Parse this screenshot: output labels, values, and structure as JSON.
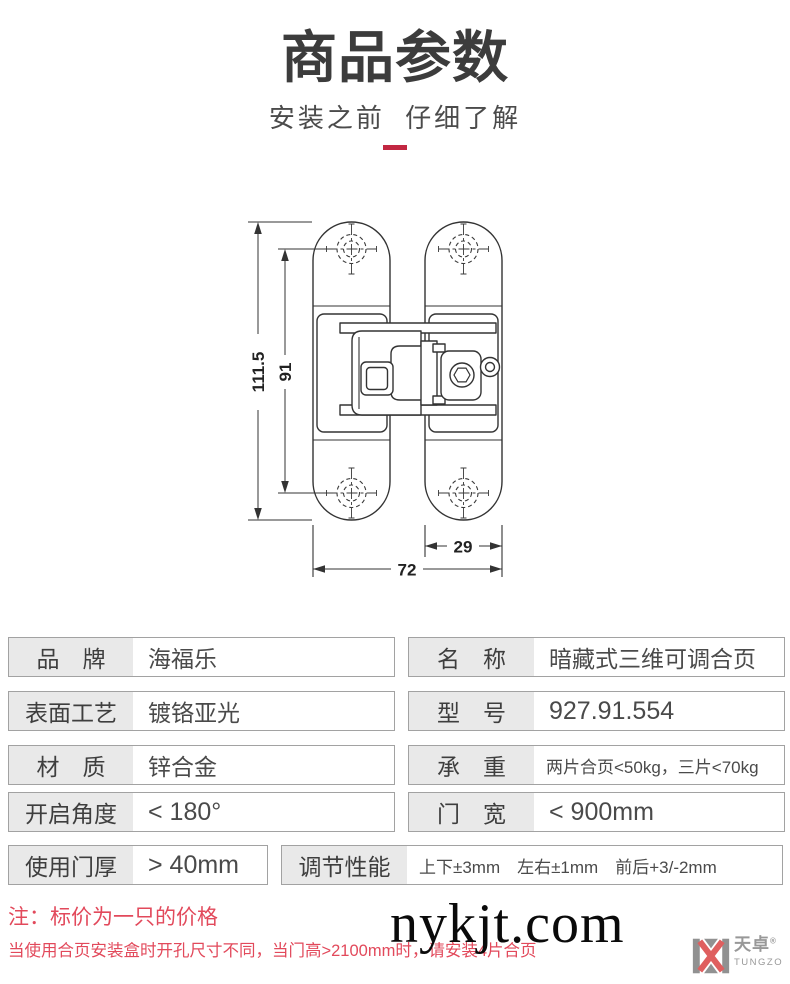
{
  "header": {
    "title": "商品参数",
    "subtitle": "安装之前 仔细了解"
  },
  "diagram": {
    "dims": {
      "total_height": "111.5",
      "hole_spacing": "91",
      "total_width": "72",
      "plate_width": "29"
    }
  },
  "specs": {
    "left": [
      {
        "label": "品　牌",
        "value": "海福乐"
      },
      {
        "label": "表面工艺",
        "value": "镀铬亚光"
      },
      {
        "label": "材　质",
        "value": "锌合金"
      },
      {
        "label": "开启角度",
        "value": "< 180°"
      },
      {
        "label": "使用门厚",
        "value": "> 40mm"
      }
    ],
    "right": [
      {
        "label": "名　称",
        "value": "暗藏式三维可调合页"
      },
      {
        "label": "型　号",
        "value": "927.91.554"
      },
      {
        "label": "承　重",
        "value": "两片合页<50kg，三片<70kg"
      },
      {
        "label": "门　宽",
        "value": "< 900mm"
      },
      {
        "label": "调节性能",
        "value": "上下±3mm　左右±1mm　前后+3/-2mm"
      }
    ]
  },
  "notes": {
    "line1": "注：标价为一只的价格",
    "line2": "当使用合页安装盒时开孔尺寸不同，当门高>2100mm时，请安装4片合页"
  },
  "watermark": "nykjt.com",
  "brand": {
    "name": "天卓",
    "reg": "®",
    "latin": "TUNGZO"
  },
  "colors": {
    "accent_bar": "#c22742",
    "note_red": "#e2495b",
    "label_bg": "#e9e9e9",
    "box_border": "#a2a2a2",
    "drawing_line": "#333333",
    "logo_gray": "#919191",
    "logo_red": "#df5f5f"
  }
}
